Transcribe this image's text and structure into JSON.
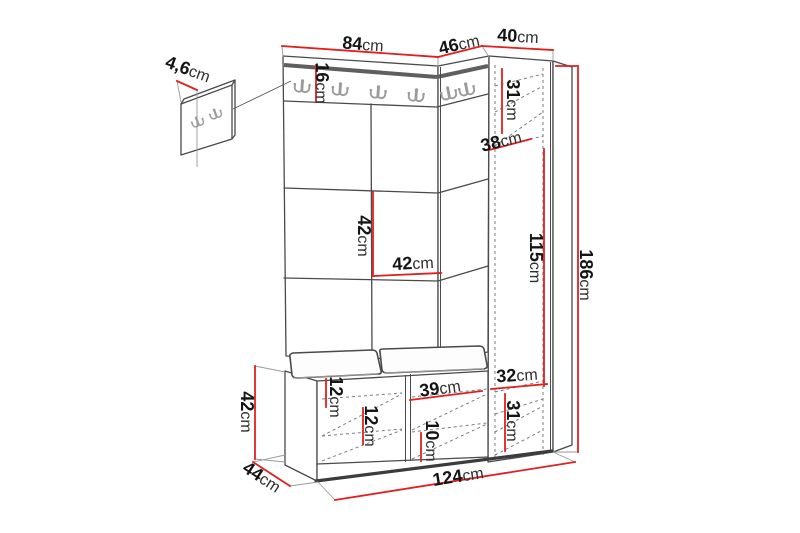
{
  "diagram": {
    "type": "furniture-dimension-diagram",
    "unit": "cm",
    "colors": {
      "dimension_red": "#e02020",
      "line_dark": "#4a4a4a",
      "hook_gray": "#9b9b9b"
    },
    "dimensions": {
      "wall_panel_depth": {
        "value": "4,6",
        "unit": "cm"
      },
      "hall_panel_width": {
        "value": "84",
        "unit": "cm"
      },
      "corner_panel_width": {
        "value": "46",
        "unit": "cm"
      },
      "wardrobe_width": {
        "value": "40",
        "unit": "cm"
      },
      "hook_rail_height": {
        "value": "16",
        "unit": "cm"
      },
      "wardrobe_top_section_height": {
        "value": "31",
        "unit": "cm"
      },
      "wardrobe_inner_depth": {
        "value": "38",
        "unit": "cm"
      },
      "panel_tile_height": {
        "value": "42",
        "unit": "cm"
      },
      "panel_tile_width": {
        "value": "42",
        "unit": "cm"
      },
      "wardrobe_hanging_height": {
        "value": "115",
        "unit": "cm"
      },
      "total_height": {
        "value": "186",
        "unit": "cm"
      },
      "wardrobe_bottom_width": {
        "value": "32",
        "unit": "cm"
      },
      "wardrobe_bottom_height": {
        "value": "31",
        "unit": "cm"
      },
      "bench_height": {
        "value": "42",
        "unit": "cm"
      },
      "bench_depth": {
        "value": "44",
        "unit": "cm"
      },
      "bench_shelf_gap_top": {
        "value": "12",
        "unit": "cm"
      },
      "bench_shelf_gap_bottom": {
        "value": "12",
        "unit": "cm"
      },
      "bench_right_compartment_width": {
        "value": "39",
        "unit": "cm"
      },
      "bench_right_shelf_height": {
        "value": "10",
        "unit": "cm"
      },
      "total_width": {
        "value": "124",
        "unit": "cm"
      }
    }
  }
}
